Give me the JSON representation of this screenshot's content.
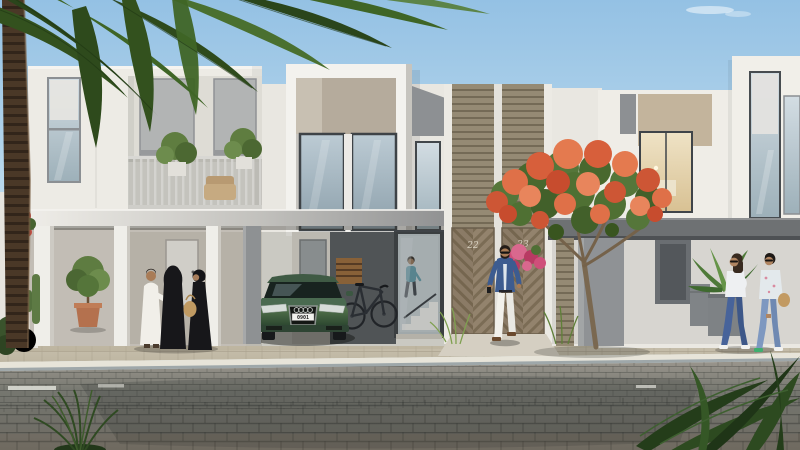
{
  "scene": {
    "kind": "architectural-exterior-rendering",
    "description": "Row of modern white two-storey townhouses with carports, a parked green car, a bicycle, residents walking, a flowering flame tree, palms and desert landscaping along a cobbled street",
    "labels": {
      "house_number_left_door": "22",
      "house_number_right_door": "23",
      "car_license_plate": "0901"
    },
    "elements": [
      "palm-tree",
      "flame-tree",
      "townhouse-row",
      "carport-canopy",
      "green-car",
      "bicycle",
      "man-in-kandura",
      "women-in-abayas",
      "man-in-blazer",
      "two-women-walking",
      "person-on-stairs",
      "wooden-chevron-gates",
      "balcony-with-plants",
      "cobbled-street"
    ],
    "palette": {
      "sky_top": "#94c1e4",
      "sky_horizon": "#e9f3f7",
      "facade_white": "#edebe5",
      "facade_recess": "#dedcd5",
      "panel_gray": "#8d9093",
      "panel_beige": "#c3b49c",
      "slat_cladding": "#8d8271",
      "gate_wood": "#87775f",
      "canopy_dark": "#6e7173",
      "car_green": "#3c5a40",
      "flame_flower_orange": "#d95f3c",
      "foliage_dark_green": "#33511e",
      "sidewalk_tan": "#c8c1af",
      "road_gray": "#6d6f6c",
      "abaya_black": "#17171a",
      "kandura_white": "#f1efe9",
      "blazer_blue": "#3d5c90",
      "jeans_blue": "#47639a",
      "handbag_tan": "#c09a62"
    }
  }
}
